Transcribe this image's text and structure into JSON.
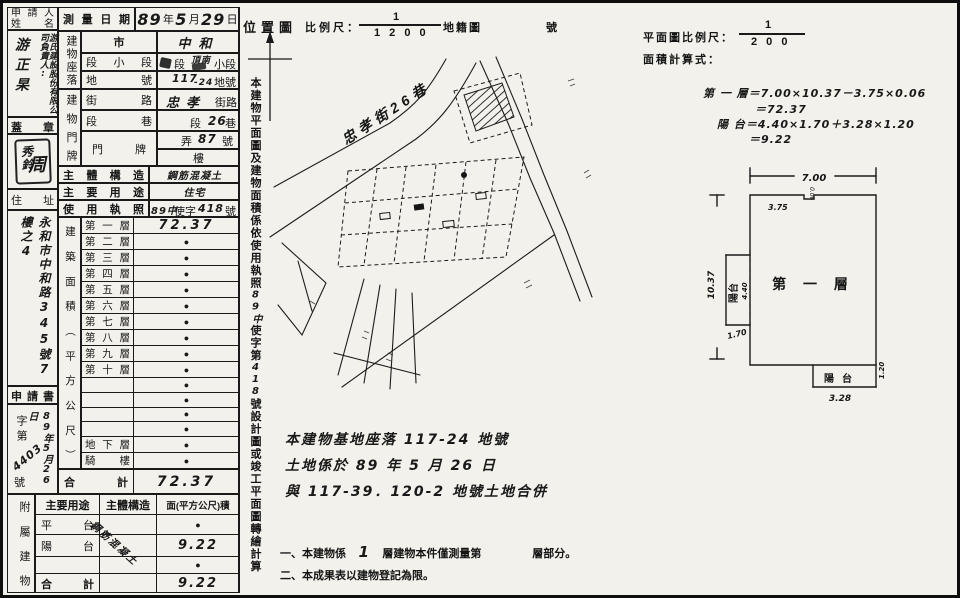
{
  "applicant": {
    "label1": "申請人",
    "label2": "姓名",
    "company": "游氏建設股份",
    "company2": "有限公司",
    "title": "負責人:",
    "name": "游正杲"
  },
  "seal_section": {
    "label": "蓋章",
    "seal_right": "周",
    "seal_left": "秀鈴"
  },
  "survey": {
    "label": "測量日期",
    "year": "89",
    "y_unit": "年",
    "month": "5",
    "m_unit": "月",
    "day": "29",
    "d_unit": "日"
  },
  "site": {
    "group": "建物座落",
    "city_label": "市",
    "city": "中和",
    "seg_label": "段小段",
    "seg_pre": "段",
    "seg_stamp": "頂南",
    "seg_suf": "小段",
    "land_label": "地號",
    "land_main": "117",
    "land_sub": "-24",
    "land_suf": "地號"
  },
  "plate": {
    "group": "建物門牌",
    "street_label": "街路",
    "street": "忠孝",
    "street_suf": "街路",
    "lane_label": "段巷",
    "lane_pre": "段",
    "lane_num": "26",
    "lane_suf": "巷",
    "plate_label": "門牌",
    "alley_pre": "弄",
    "alley_num": "87",
    "alley_suf": "號",
    "floor_suf": "樓"
  },
  "structure": {
    "label": "主體構造",
    "value": "鋼筋混凝土"
  },
  "usage": {
    "label": "主要用途",
    "value": "住宅"
  },
  "license": {
    "label": "使用執照",
    "pre": "89中",
    "mid": "使字",
    "num": "418",
    "suf": "號"
  },
  "address": {
    "label": "住址",
    "line1": "永和市中和路345號",
    "line2": "7樓之4"
  },
  "application": {
    "label": "申請書",
    "zi": "字第",
    "number": "4403",
    "hao": "號",
    "date": "89年5月26日"
  },
  "area_table": {
    "group": "建築面積（平方公尺）",
    "floors": [
      {
        "label": "第一層",
        "value": "72.37"
      },
      {
        "label": "第二層",
        "value": "●"
      },
      {
        "label": "第三層",
        "value": "●"
      },
      {
        "label": "第四層",
        "value": "●"
      },
      {
        "label": "第五層",
        "value": "●"
      },
      {
        "label": "第六層",
        "value": "●"
      },
      {
        "label": "第七層",
        "value": "●"
      },
      {
        "label": "第八層",
        "value": "●"
      },
      {
        "label": "第九層",
        "value": "●"
      },
      {
        "label": "第十層",
        "value": "●"
      },
      {
        "label": "",
        "value": "●"
      },
      {
        "label": "",
        "value": "●"
      },
      {
        "label": "",
        "value": "●"
      },
      {
        "label": "",
        "value": "●"
      },
      {
        "label": "地下層",
        "value": "●"
      },
      {
        "label": "騎樓",
        "value": "●"
      }
    ],
    "total_label": "合計",
    "total": "72.37"
  },
  "annex": {
    "group": "附屬建物",
    "h_use": "主要用途",
    "h_structure": "主體構造",
    "h_area": "面(平方公尺)積",
    "structure_note": "鋼筋混凝土",
    "rows": [
      {
        "use": "平台",
        "area": "●"
      },
      {
        "use": "陽台",
        "area": "9.22"
      },
      {
        "use": "",
        "area": "●"
      },
      {
        "use": "合計",
        "area": "9.22"
      }
    ]
  },
  "side_note": {
    "p1": "本建物平面圖及建物面積係依使用執照",
    "hw1": "89中",
    "p2": "使字第",
    "hw2": "418",
    "p3": "號設計圖或竣工平面圖轉繪計算"
  },
  "map": {
    "title": "位置圖",
    "scale_label": "比例尺：",
    "num": "1",
    "den": "1 2 0 0",
    "type": "地籍圖",
    "sheet": "號",
    "road": "忠孝街26巷"
  },
  "base_note": {
    "l1": "本建物基地座落 117-24 地號",
    "l2": "土地係於 89 年 5 月 26 日",
    "l3": "與 117-39．120-2  地號土地合併"
  },
  "notes": {
    "n1a": "一、本建物係",
    "n1_hw": "1",
    "n1b": "層建物本件僅測量第",
    "n1c": "層部分。",
    "n2": "二、本成果表以建物登記為限。"
  },
  "plan": {
    "scale_label": "平面圖比例尺：",
    "num": "1",
    "den": "2 0 0",
    "calc_label": "面積計算式：",
    "f1": "第 一 層＝7.00×10.37－3.75×0.06",
    "f2": "＝72.37",
    "f3": "陽 台＝4.40×1.70＋3.28×1.20",
    "f4": "＝9.22",
    "room": "第 一 層",
    "dim_top": "7.00",
    "dim_left": "10.37",
    "dim_375": "3.75",
    "dim_006": "0.06",
    "balcony_left": "陽台",
    "balcony_bottom": "陽台",
    "dim_440": "4.40",
    "dim_170": "1.70",
    "dim_328": "3.28",
    "dim_120": "1.20"
  }
}
